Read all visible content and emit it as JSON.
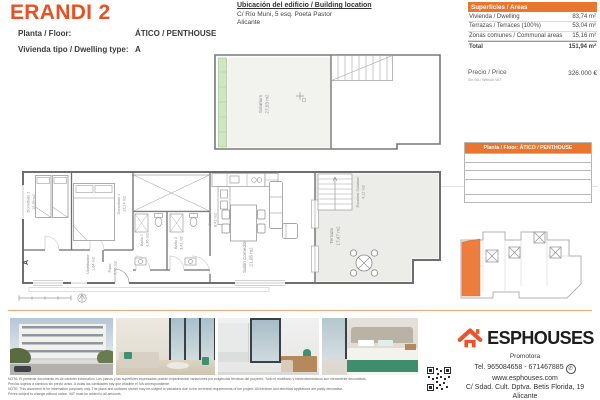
{
  "header": {
    "title": "ERANDI 2",
    "floor_label": "Planta / Floor:",
    "floor_value": "ÁTICO / PENTHOUSE",
    "dwelling_type_label": "Vivienda tipo / Dwelling type:",
    "dwelling_type_value": "A"
  },
  "location": {
    "title": "Ubicación del edificio / Building location",
    "address": "C/ Río Muni, 5 esq. Poeta Pastor",
    "city": "Alicante"
  },
  "areas_table": {
    "header": "Superficies / Areas",
    "rows": [
      {
        "label": "Vivienda / Dwelling",
        "value": "83,74 m²"
      },
      {
        "label": "Terrazas / Terraces (100%)",
        "value": "53,04 m²"
      },
      {
        "label": "Zonas comunes / Communal areas",
        "value": "15,16 m²"
      }
    ],
    "total_label": "Total",
    "total_value": "151,94 m²",
    "price_label": "Precio / Price",
    "price_note": "Sin IVA / Without VAT",
    "price_value": "326.000 €"
  },
  "floor_table": {
    "header": "Planta / Floor: ÁTICO / PENTHOUSE"
  },
  "floor_plan": {
    "section_mark": "A",
    "rooms": [
      {
        "label": "Solarium",
        "area": "27,53 m2"
      },
      {
        "label": "Dormitorio 2",
        "area": "10,35 m2"
      },
      {
        "label": "Dormitorio 1",
        "area": "12,14 m2"
      },
      {
        "label": "Distribuidor",
        "area": "1,64 m2"
      },
      {
        "label": "Baño 1",
        "area": "4,36 m2"
      },
      {
        "label": "Baño 2",
        "area": "3,42 m2"
      },
      {
        "label": "Cocina",
        "area": "8,41 m2"
      },
      {
        "label": "Salón Comedor",
        "area": "21,06 m2"
      },
      {
        "label": "Paso",
        "area": "7,76 m2"
      },
      {
        "label": "Terraza",
        "area": "17,47 m2"
      },
      {
        "label": "Escalera Solarium",
        "area": "4,12 m2"
      }
    ]
  },
  "footer": {
    "brand": "ESPHOUSES",
    "brand_subtitle": "Promotora",
    "phone": "Tel. 965084658 - 671467885",
    "website": "www.esphouses.com",
    "address": "C/ Sdad. Cult. Dptva. Betis Florida, 19",
    "city": "Alicante"
  },
  "disclaimer": {
    "line1": "NOTA: El presente documento es de carácter informativo. Los planos y las superficies expresadas podrán experimentar variaciones por exigencias técnicas del proyecto. Todo el mobiliario y electrodomésticos son meramente decorativos.",
    "line2": "Precios sujetos a cambios sin previo aviso. A todas las cantidades hay que añadirle el IVA correspondiente.",
    "line3": "NOTE: This document is for information purposes only. The plans and surfaces shown may be subject to variations due to the technical requirements of the project. All furniture and electrical appliances are partly decorative.",
    "line4": "Prices subject to change without notice. VAT must be added to all amounts."
  },
  "colors": {
    "accent_orange": "#E85024",
    "table_header_orange": "#E8762F",
    "highlighted_unit_orange": "#ED7C3F",
    "planter_green": "#CFE5C4",
    "divider_orange": "#E9A477"
  }
}
